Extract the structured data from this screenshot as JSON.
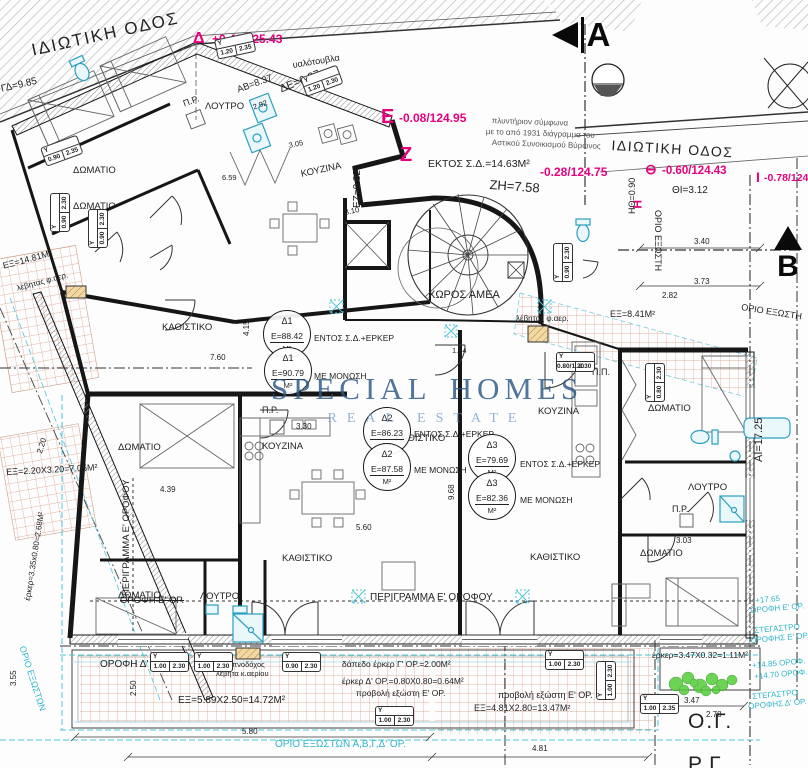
{
  "watermark": {
    "word1": "SPECIAL",
    "word2": "HOMES",
    "line2": "REAL ESTATE"
  },
  "streets": {
    "left": "ΙΔΙΩΤΙΚΗ ΟΔΟΣ",
    "right": "ΙΔΙΩΤΙΚΗ ΟΔΟΣ"
  },
  "sections": {
    "a": "A",
    "b": "B"
  },
  "survey": {
    "delta": {
      "sym": "Δ",
      "val": "+0.40/125.43"
    },
    "epsilon": {
      "sym": "Ε",
      "val": "-0.08/124.95"
    },
    "zeta": {
      "sym": "Ζ"
    },
    "eta": {
      "sym": "Η"
    },
    "theta": {
      "sym": "⊖",
      "val": "-0.60/124.43"
    },
    "iota": {
      "sym": "Ι",
      "val": "-0.78/124.2"
    },
    "mid": "-0.28/124.75"
  },
  "edges": {
    "ab": "ΑΒ=8.37",
    "gd": "ΓΔ=9.85",
    "de": "ΔΕ=6.27",
    "ez": "ΕΖ=0.82",
    "zh": "ΖΗ=7.58",
    "hth": "ΗΘ=0.90",
    "thi": "ΘΙ=3.12",
    "ai": "ΑΙ=17.25"
  },
  "rooms": {
    "bedroom": "ΔΩΜΑΤΙΟ",
    "bath": "ΛΟΥΤΡΟ",
    "kitchen": "ΚΟΥΖΙΝΑ",
    "living": "ΚΑΘΙΣΤΙΚΟ",
    "amea": "ΧΩΡΟΣ ΑΜΕΑ",
    "pr": "Π.Ρ.",
    "pp": "Π.Π."
  },
  "apartments": [
    {
      "tag": "Δ1",
      "area": "Ε=88.42",
      "unit": "Μ²",
      "note": "ΕΝΤΟΣ Σ.Δ.+ΕΡΚΕΡ"
    },
    {
      "tag": "Δ1",
      "area": "Ε=90.79",
      "unit": "Μ²",
      "note": "ΜΕ ΜΟΝΩΣΗ"
    },
    {
      "tag": "Δ2",
      "area": "Ε=86.23",
      "unit": "Μ²",
      "note": "ΕΝΤΟΣ Σ.Δ.+ΕΡΚΕΡ"
    },
    {
      "tag": "Δ2",
      "area": "Ε=87.58",
      "unit": "Μ²",
      "note": "ΜΕ ΜΟΝΩΣΗ"
    },
    {
      "tag": "Δ3",
      "area": "Ε=79.69",
      "unit": "Μ²",
      "note": "ΕΝΤΟΣ Σ.Δ.+ΕΡΚΕΡ"
    },
    {
      "tag": "Δ3",
      "area": "Ε=82.36",
      "unit": "Μ²",
      "note": "ΜΕ ΜΟΝΩΣΗ"
    }
  ],
  "areas": {
    "ektos": "ΕΚΤΟΣ Σ.Δ.=14.63Μ²",
    "ex1": "ΕΞ=14.81Μ²",
    "ex2": "ΕΞ=2.20Χ3.20=7.05Μ²",
    "ex3": "ΕΞ=8.41Μ²",
    "ex4": "ΕΞ=5.89Χ2.50=14.72Μ²",
    "ex5": "ΕΞ=4.81Χ2.80=13.47Μ²",
    "erker1": "έρκερ=3.47Χ0.32=1.11Μ²",
    "erker2": "έρκερ Δ' ΟΡ.=0.80Χ0.80=0.64Μ²",
    "erker3": "έρκερ=3.35x0.80=2.68Μ²",
    "erker4": "δάπεδο έρκερ Γ' ΟΡ.=2.00Μ²"
  },
  "notes": {
    "glass": "υαλότουβλα",
    "laundry1": "πλυντήριον σύμφωνα",
    "laundry2": "με το από 1931 διάγραμμα του",
    "laundry3": "Αστικού Συνοικισμού Βύρωνος",
    "boiler": "λέβητας φ.αερ.",
    "chimney1": "καπνοδόχος",
    "chimney2": "λέβητα κ.αερίου"
  },
  "outlines": {
    "perigramma": "ΠΕΡΙΓΡΑΜΜΑ Ε' ΟΡΟΦΟΥ",
    "orofi_d": "ΟΡΟΦΗ Δ' ΟΡ.",
    "orofi_e": "ΟΡΟΦΗ Ε' ΟΡ.",
    "orio_exoston_abgd": "ΟΡΙΟ ΕΞΩΣΤΩΝ Α,Β,Γ,Δ' ΟΡ.",
    "orio_exoston": "ΟΡΙΟ ΕΞΩΣΤΩΝ",
    "orio_exosti": "ΟΡΙΟ ΕΞΩΣΤΗ",
    "provoli": "προβολή εξώστη Ε' ΟΡ.",
    "og": "Ο.Γ.",
    "rg": "Ρ.Γ."
  },
  "levels": [
    "+17.65",
    "ΟΡΟΦΗ Ε' ΟΡ.",
    "ΣΤΕΓΑΣΤΡΟ",
    "ΟΡΟΦΗΣ Ε' ΟΡ.",
    "+14.85 ΟΡΟΦ.",
    "+14.70 ΟΡΟΦ.",
    "ΣΤΕΓΑΣΤΡΟ",
    "ΟΡΟΦΗΣ Δ' ΟΡ."
  ],
  "door_tags": {
    "label": "Υ",
    "sizes": [
      [
        "1.20",
        "2.35"
      ],
      [
        "1.20",
        "2.30"
      ],
      [
        "0.90",
        "2.30"
      ],
      [
        "0.90",
        "2.35"
      ],
      [
        "0.80/1.20",
        "2.30"
      ],
      [
        "1.00",
        "2.30"
      ],
      [
        "0.80",
        "2.30"
      ],
      [
        "1.00",
        "2.35"
      ]
    ]
  },
  "dims": [
    "3.40",
    "3.73",
    "2.82",
    "2.92",
    "3.05",
    "7.60",
    "4.15",
    "4.39",
    "3.30",
    "5.60",
    "5.80",
    "4.81",
    "3.47",
    "2.78",
    "3.03",
    "9.68",
    "2.50",
    "6.59",
    "3.55",
    "1.54",
    "3.10",
    "2.20"
  ]
}
